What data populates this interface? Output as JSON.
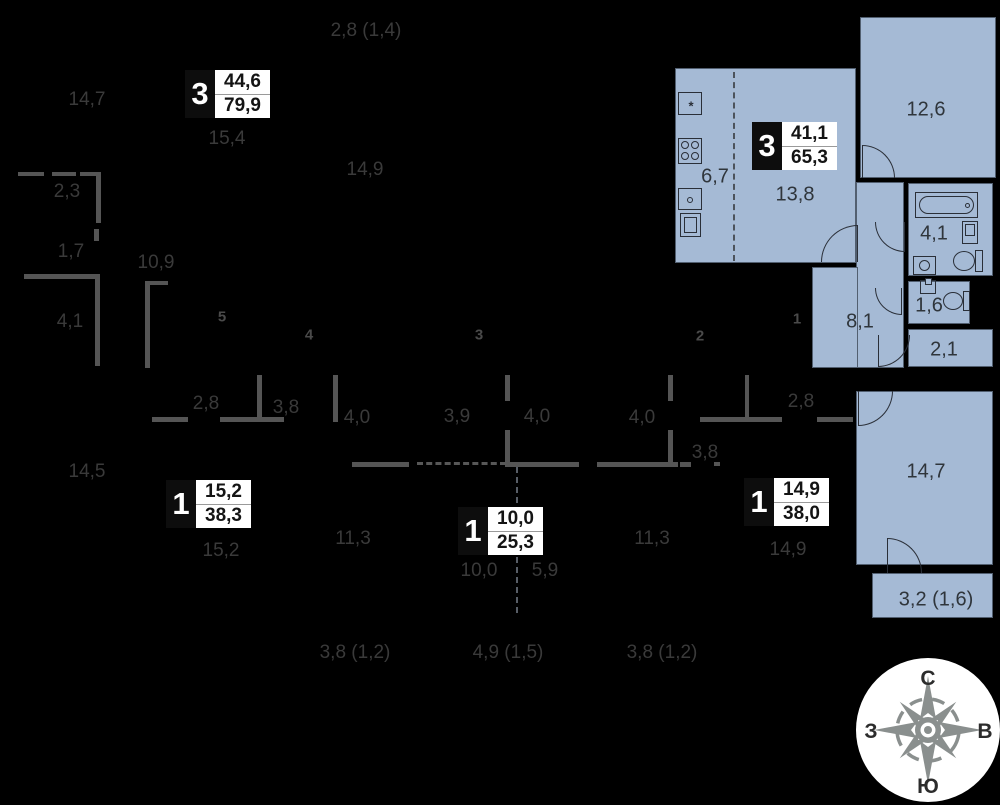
{
  "badges": {
    "apt_a": {
      "rooms": "3",
      "living": "44,6",
      "total": "79,9"
    },
    "apt_b": {
      "rooms": "3",
      "living": "41,1",
      "total": "65,3"
    },
    "apt_c": {
      "rooms": "1",
      "living": "15,2",
      "total": "38,3"
    },
    "apt_d": {
      "rooms": "1",
      "living": "10,0",
      "total": "25,3"
    },
    "apt_e": {
      "rooms": "1",
      "living": "14,9",
      "total": "38,0"
    }
  },
  "labels": {
    "top_balcony": "2,8 (1,4)",
    "tl_147": "14,7",
    "tl_154": "15,4",
    "tl_149": "14,9",
    "l_23": "2,3",
    "l_17": "1,7",
    "l_109": "10,9",
    "l_41": "4,1",
    "l_145": "14,5",
    "k_67": "6,7",
    "k_138": "13,8",
    "r_126": "12,6",
    "bath_41": "4,1",
    "wc_16": "1,6",
    "st_21": "2,1",
    "hall_81": "8,1",
    "r_147": "14,7",
    "balcony": "3,2 (1,6)",
    "c_28a": "2,8",
    "c_38a": "3,8",
    "c_40a": "4,0",
    "c_39": "3,9",
    "c_40b": "4,0",
    "c_40c": "4,0",
    "c_28b": "2,8",
    "c_38b": "3,8",
    "b_152": "15,2",
    "b_113a": "11,3",
    "b_100": "10,0",
    "b_59": "5,9",
    "b_113b": "11,3",
    "b_149": "14,9",
    "bot_38a": "3,8 (1,2)",
    "bot_49": "4,9 (1,5)",
    "bot_38b": "3,8 (1,2)"
  },
  "unit_numbers": {
    "u1": "1",
    "u2": "2",
    "u3": "3",
    "u4": "4",
    "u5": "5"
  },
  "compass": {
    "north": "С",
    "south": "Ю",
    "west": "З",
    "east": "В"
  },
  "fixtures": {
    "fridge_symbol": "*"
  },
  "colors": {
    "background": "#000000",
    "apartment_fill": "#a5bad5",
    "neighbor_wall": "#555555",
    "dimension_text": "#3a3a3a",
    "badge_bg": "#0d0d0d",
    "badge_panel": "#ffffff",
    "compass_star": "#8a8f8e"
  }
}
